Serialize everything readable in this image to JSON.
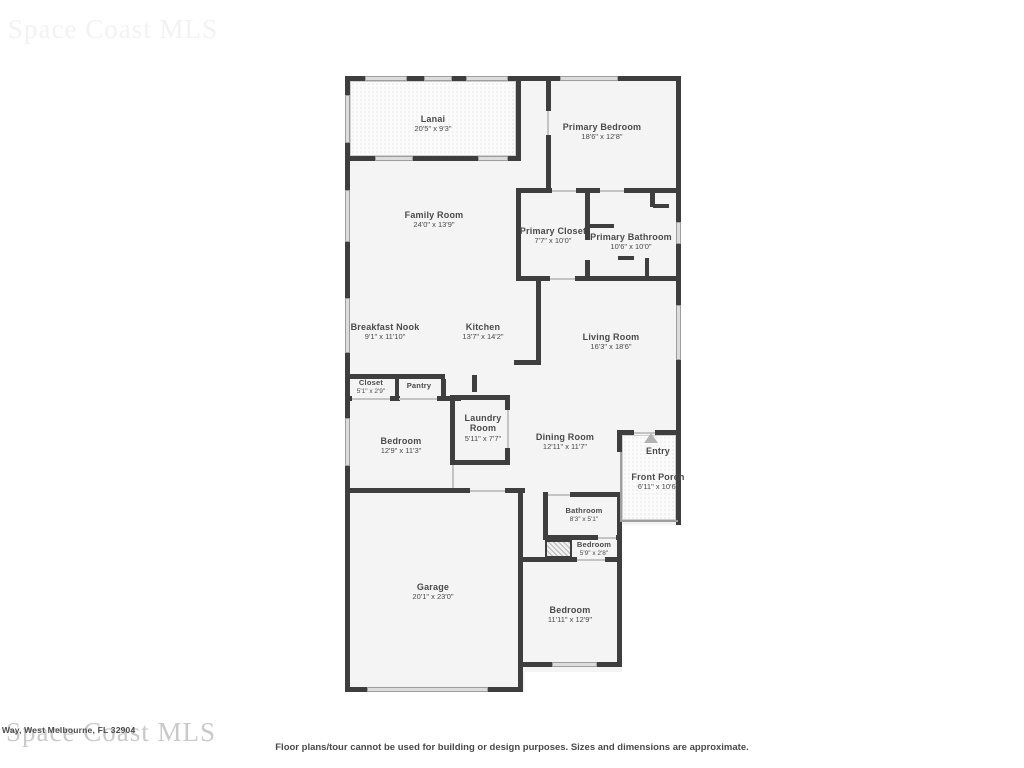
{
  "watermark": {
    "text": "Space Coast MLS"
  },
  "address_fragment": "tos Way, West Melbourne, FL 32904",
  "disclaimer": "Floor plans/tour cannot be used for building or design purposes. Sizes and dimensions are approximate.",
  "icons": {
    "entry_direction": "triangle-up"
  },
  "colors": {
    "wall": "#3e3e3e",
    "floor": "#f4f4f4",
    "window": "#dcdcdc",
    "door": "#c4c4c4",
    "label": "#4a4a4a",
    "watermark": "#c9c9c9",
    "texture_dot": "#d8d8d8",
    "entry_arrow": "#b3b3b3"
  },
  "rooms": {
    "lanai": {
      "name": "Lanai",
      "dims": "20'5\" x 9'3\""
    },
    "primary_bedroom": {
      "name": "Primary Bedroom",
      "dims": "18'6\" x 12'8\""
    },
    "family_room": {
      "name": "Family Room",
      "dims": "24'0\" x 13'9\""
    },
    "primary_closet": {
      "name": "Primary Closet",
      "dims": "7'7\" x 10'0\""
    },
    "primary_bathroom": {
      "name": "Primary Bathroom",
      "dims": "10'6\" x 10'0\""
    },
    "breakfast_nook": {
      "name": "Breakfast Nook",
      "dims": "9'1\" x 11'10\""
    },
    "kitchen": {
      "name": "Kitchen",
      "dims": "13'7\" x 14'2\""
    },
    "living_room": {
      "name": "Living Room",
      "dims": "16'3\" x 18'6\""
    },
    "closet": {
      "name": "Closet",
      "dims": "5'1\" x 2'9\""
    },
    "pantry": {
      "name": "Pantry",
      "dims": ""
    },
    "laundry_room": {
      "name": "Laundry Room",
      "dims": "5'11\" x 7'7\""
    },
    "bedroom_left": {
      "name": "Bedroom",
      "dims": "12'9\" x 11'3\""
    },
    "dining_room": {
      "name": "Dining Room",
      "dims": "12'11\" x 11'7\""
    },
    "entry": {
      "name": "Entry",
      "dims": ""
    },
    "front_porch": {
      "name": "Front Porch",
      "dims": "6'11\" x 10'6\""
    },
    "bathroom": {
      "name": "Bathroom",
      "dims": "8'3\" x 5'1\""
    },
    "bedroom_closet": {
      "name": "Bedroom",
      "dims": "5'9\" x 2'8\""
    },
    "garage": {
      "name": "Garage",
      "dims": "20'1\" x 23'0\""
    },
    "bedroom_bottom": {
      "name": "Bedroom",
      "dims": "11'11\" x 12'9\""
    }
  }
}
